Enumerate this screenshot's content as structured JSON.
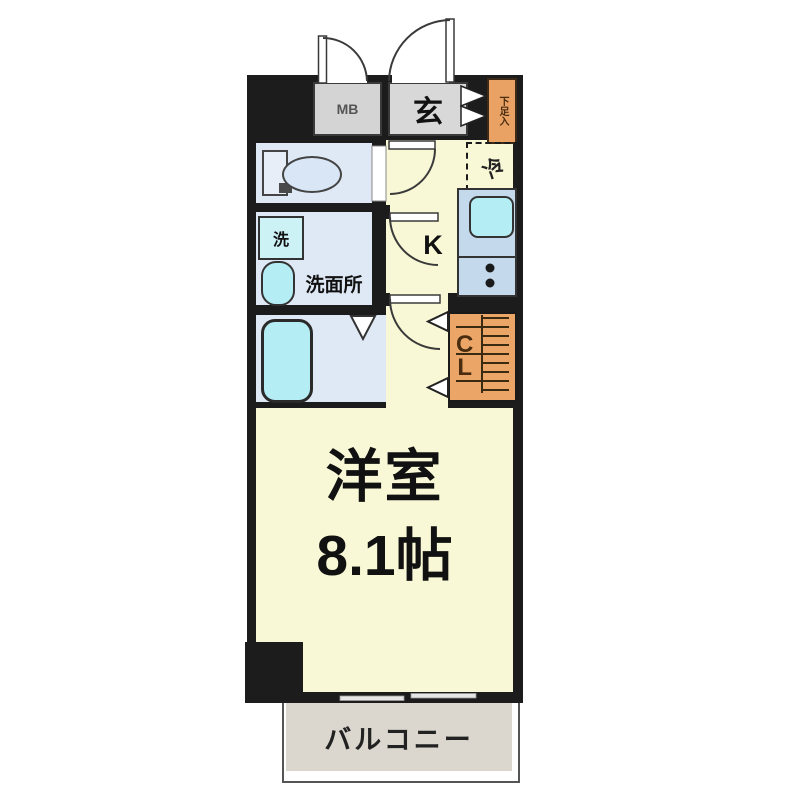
{
  "floorplan": {
    "entrance_label": "玄",
    "meter_box_label": "MB",
    "shoe_storage_label": "下足入",
    "refrigerator_label": "冷",
    "kitchen_label": "K",
    "washer_label": "洗",
    "washroom_label": "洗面所",
    "closet_label": "C\nL",
    "room_label": "洋室",
    "room_size_label": "8.1帖",
    "balcony_label": "バルコニー",
    "colors": {
      "wall": "#1c1c1c",
      "floor_yellow": "#f8f8d6",
      "wet_floor_blue": "#dfe9f5",
      "fixture_cyan": "#b5edf4",
      "counter_blue": "#c5d9ec",
      "box_gray": "#d4d4d4",
      "storage_orange": "#e9a263",
      "balcony_gray": "#dbd7cf",
      "text_dark": "#111111"
    }
  }
}
